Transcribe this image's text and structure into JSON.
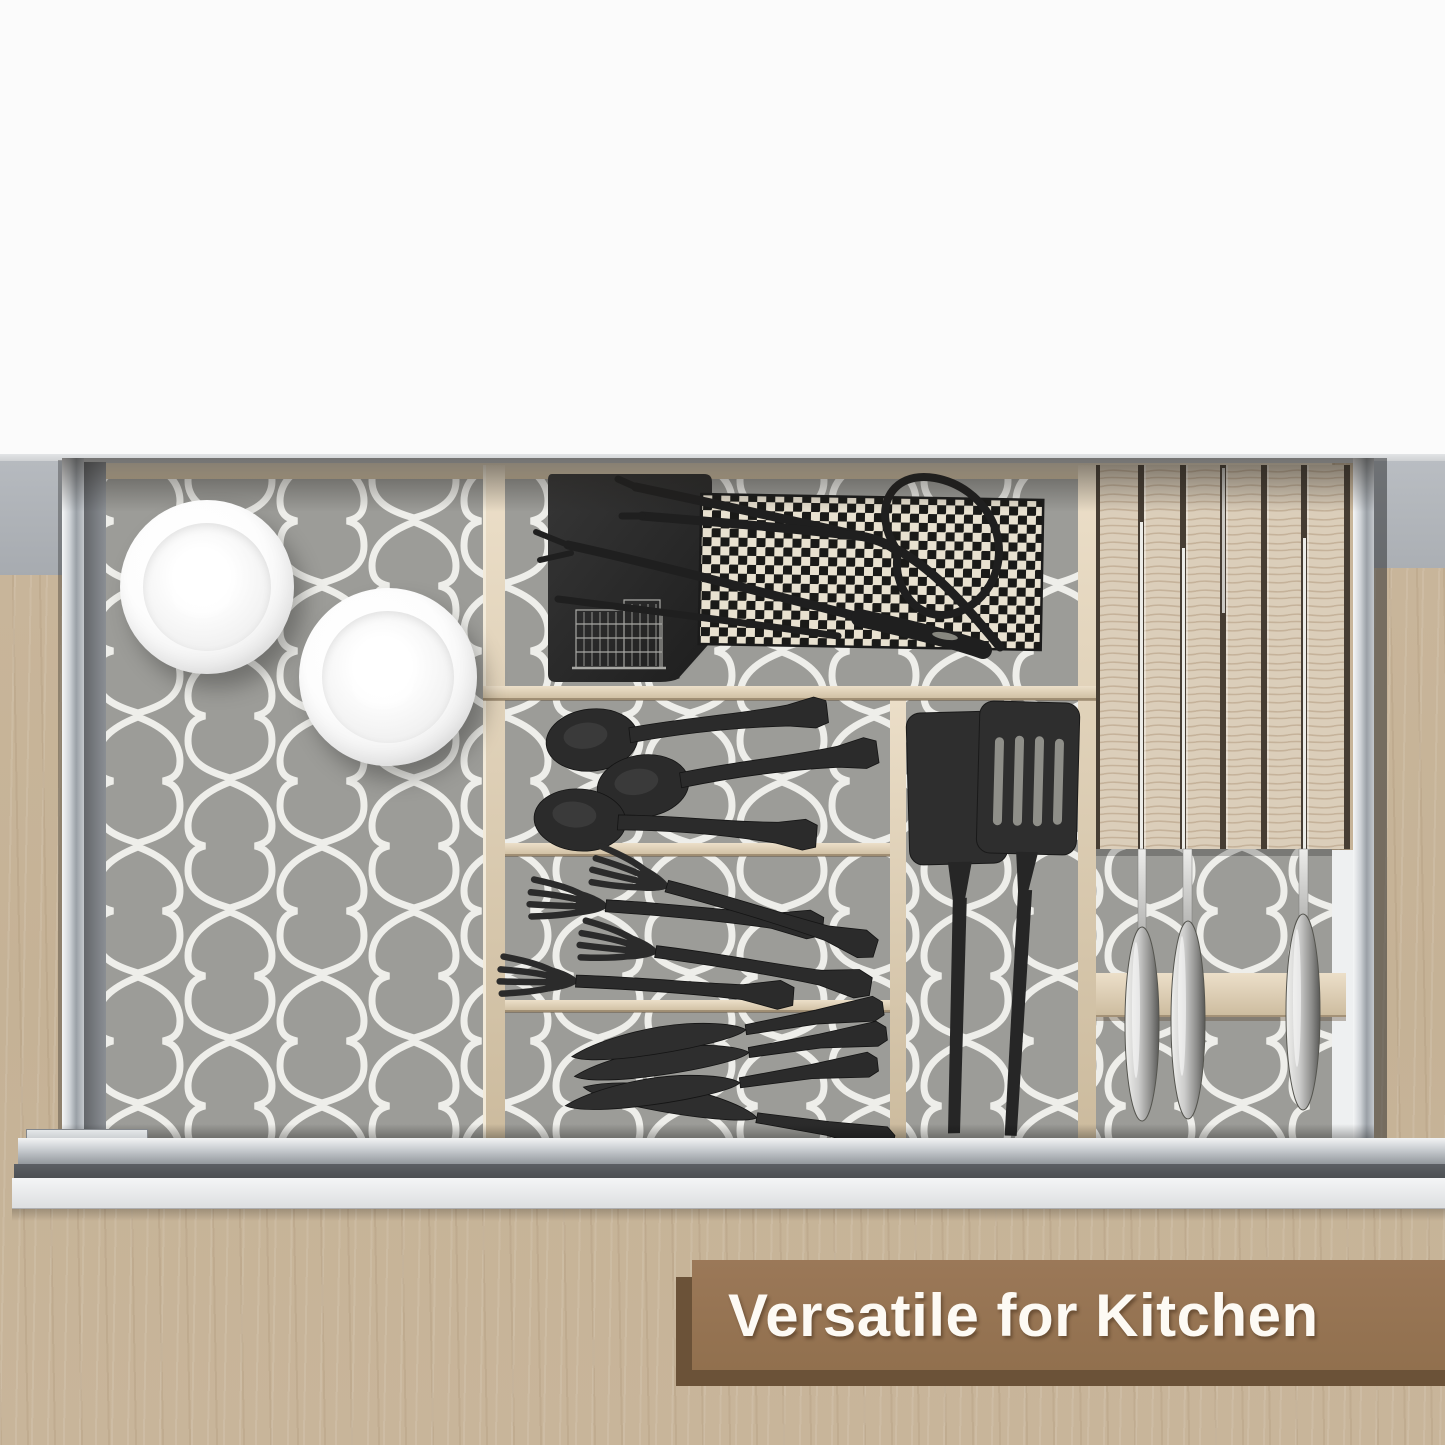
{
  "banner": {
    "text": "Versatile for Kitchen",
    "panel_color": "#9b7858",
    "shadow_color": "#6b5238",
    "text_color": "#fdfaf4"
  },
  "scene": {
    "description": "Open kitchen drawer, top view, lined with gray quatrefoil shelf liner and bamboo organizers",
    "liner": {
      "pattern": "moroccan-quatrefoil",
      "base_color": "#9c9c98",
      "line_color": "#eeeeea"
    },
    "wood_color": "#c7b499",
    "counter_color": "#b6bac0",
    "item_counts": {
      "white_bowls": 2,
      "black_spoons": 3,
      "black_forks": 4,
      "black_butter_knives": 4,
      "black_spatulas": 2,
      "grill_tongs": 1,
      "long_forks": 2,
      "houndstooth_cloths": 1,
      "black_placemats": 1,
      "knives_in_block": 3
    }
  }
}
